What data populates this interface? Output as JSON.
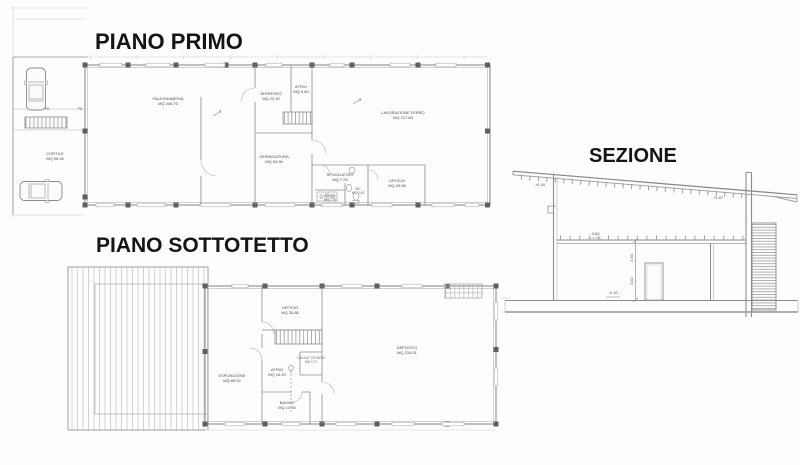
{
  "palette": {
    "paper": "#fdfdfb",
    "wall_line": "#8d8d8d",
    "light_line": "#b5b5b5",
    "column_fill": "#5f5f5f",
    "hatch": "#c8c8c8",
    "room_text": "#4e4e4e",
    "title_text": "#151515"
  },
  "primo": {
    "title": "PIANO PRIMO",
    "rooms": {
      "falegnameria": {
        "name": "FALEGNAMERIA",
        "area": "MQ 248.70"
      },
      "ingresso": {
        "name": "INGRESSO",
        "area": "MQ 22.40"
      },
      "atrio": {
        "name": "ATRIO",
        "area": "MQ 9.80"
      },
      "verniciatura": {
        "name": "VERNICIATURA",
        "area": "MQ 54.90"
      },
      "lavorazione_ferro": {
        "name": "LAVORAZIONE FERRO",
        "area": "MQ 217.80"
      },
      "spogliatoio": {
        "name": "SPOGLIATOIO",
        "area": "MQ 7.25"
      },
      "docce": {
        "name": "DOCCE",
        "area": "MQ 7.78"
      },
      "wc": {
        "name": "WC",
        "area": "MQ 2.48"
      },
      "ufficio": {
        "name": "UFFICIO",
        "area": "MQ 25.06"
      },
      "cortile": {
        "name": "CORTILE",
        "area": "MQ 98.06"
      }
    },
    "parking": {
      "spot1": "PB",
      "spot2": "PB"
    }
  },
  "sottotetto": {
    "title": "PIANO SOTTOTETTO",
    "rooms": {
      "esposizione": {
        "name": "ESPOSIZIONE",
        "area": "MQ 85.52"
      },
      "ufficio": {
        "name": "UFFICIO",
        "area": "MQ 26.88"
      },
      "locale_tecnico": {
        "name": "LOCALE TECNICO",
        "area": "MQ 7.07"
      },
      "atrio": {
        "name": "ATRIO",
        "area": "MQ 16.20"
      },
      "bagno": {
        "name": "BAGNO",
        "area": "MQ 10.55"
      },
      "deposito": {
        "name": "DEPOSITO",
        "area": "MQ 216.01"
      }
    }
  },
  "sezione": {
    "title": "SEZIONE",
    "levels": {
      "eave_left": "+5.40",
      "eave_right": "+3.87",
      "ceiling": "-0.60",
      "interior_height": "3.40",
      "wall_height": "3.82",
      "floor": "-0.10"
    }
  }
}
